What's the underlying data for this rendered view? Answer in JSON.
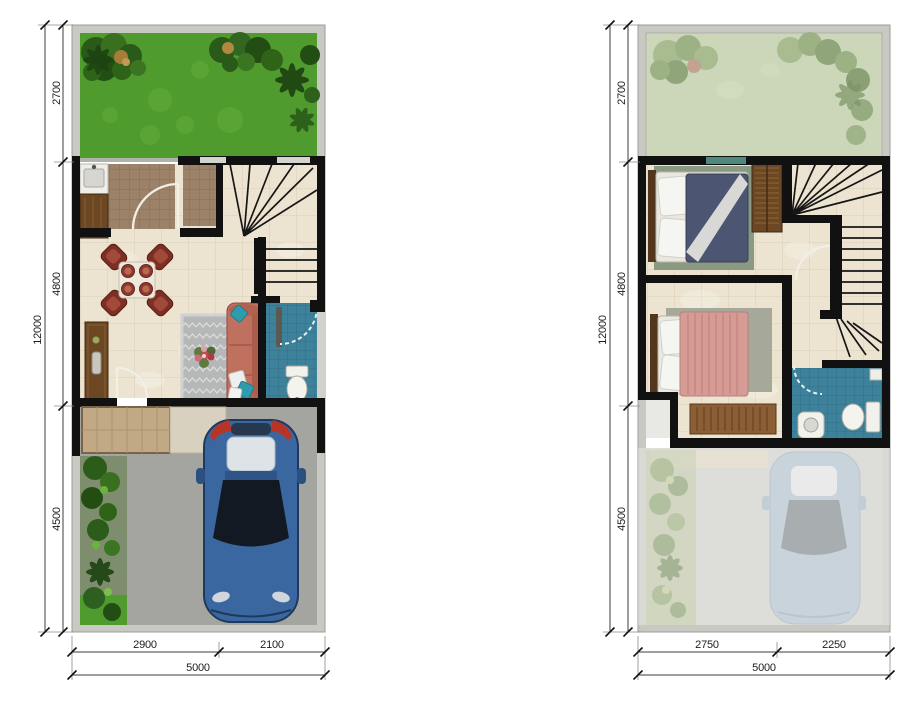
{
  "page": {
    "background": "#ffffff"
  },
  "plans": [
    {
      "id": "ground-floor",
      "vertical": {
        "total": "12000",
        "segments": [
          "2700",
          "4800",
          "4500"
        ]
      },
      "horizontal": {
        "total": "5000",
        "segments": [
          "2900",
          "2100"
        ]
      }
    },
    {
      "id": "upper-floor",
      "vertical": {
        "total": "12000",
        "segments": [
          "2700",
          "4800",
          "4500"
        ]
      },
      "horizontal": {
        "total": "5000",
        "segments": [
          "2750",
          "2250"
        ]
      }
    }
  ],
  "palette": {
    "wall": "#111111",
    "plot_border": "#c9c9c4",
    "grass": "#4f9b2e",
    "faded_grass": "#cbd7b8",
    "floor_tile": "#ece4d1",
    "kitchen_tile": "#9c8268",
    "bathroom_tile": "#3e8aa0",
    "carport": "#a4a4a0",
    "porch": "#c0a984",
    "sofa": "#c0705f",
    "dining_chair": "#7e2f24",
    "rug": "#b5b7b9",
    "car_body": "#3b67a0",
    "bed_navy": "#4c5571",
    "bed_pink": "#d69b95",
    "wood": "#6b4723",
    "pillow_teal": "#2f9cae"
  }
}
